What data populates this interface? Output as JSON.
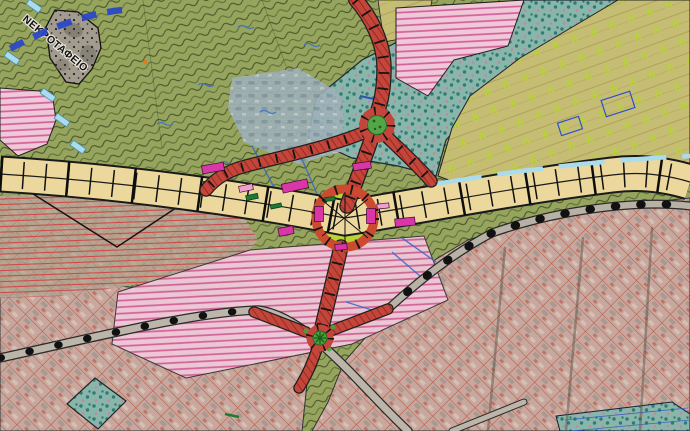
{
  "map": {
    "labels": {
      "cemetery": "ΝΕΚΡΟΤΑΦΕΙΟ"
    },
    "colors": {
      "terrain_green": "#97a45e",
      "terrain_hatch": "#5c7038",
      "terrain_hatch_dark": "#44562a",
      "orchard_base": "#c6bd74",
      "orchard_stripe": "#ada257",
      "orchard_mark": "#b5d431",
      "grove_teal": "#8ab5ab",
      "grove_dot": "#2e7d73",
      "grove_pink_dot": "#cf7fa0",
      "urban_base": "#c8a79e",
      "urban_grid": "#b35a43",
      "pink_zone": "#efc9d9",
      "pink_stripe": "#d45f98",
      "red_lines": "#d04848",
      "road_fill": "#ecd89c",
      "road_casing": "#1a1a1a",
      "new_road_red": "#c4453a",
      "new_road_hatch": "#8c241b",
      "roundabout_green": "#54a546",
      "island_chartreuse": "#b8d437",
      "gray_road": "#bcb6aa",
      "water_blue": "#2846c8",
      "light_blue": "#aadcee",
      "magenta_structure": "#d936a8",
      "bluegray_zone": "#9fb0b8",
      "cemetery_fill": "#a39c8e"
    },
    "features": {
      "zones": [
        "scrubland",
        "orchard",
        "tree-grove",
        "urban-fabric",
        "planning-strip",
        "cemetery"
      ],
      "roads": [
        "main-arterial",
        "new-red-road-north",
        "new-red-road-south",
        "local-gray-road"
      ],
      "roundabouts": [
        "north-roundabout",
        "central-roundabout",
        "south-roundabout"
      ]
    }
  }
}
